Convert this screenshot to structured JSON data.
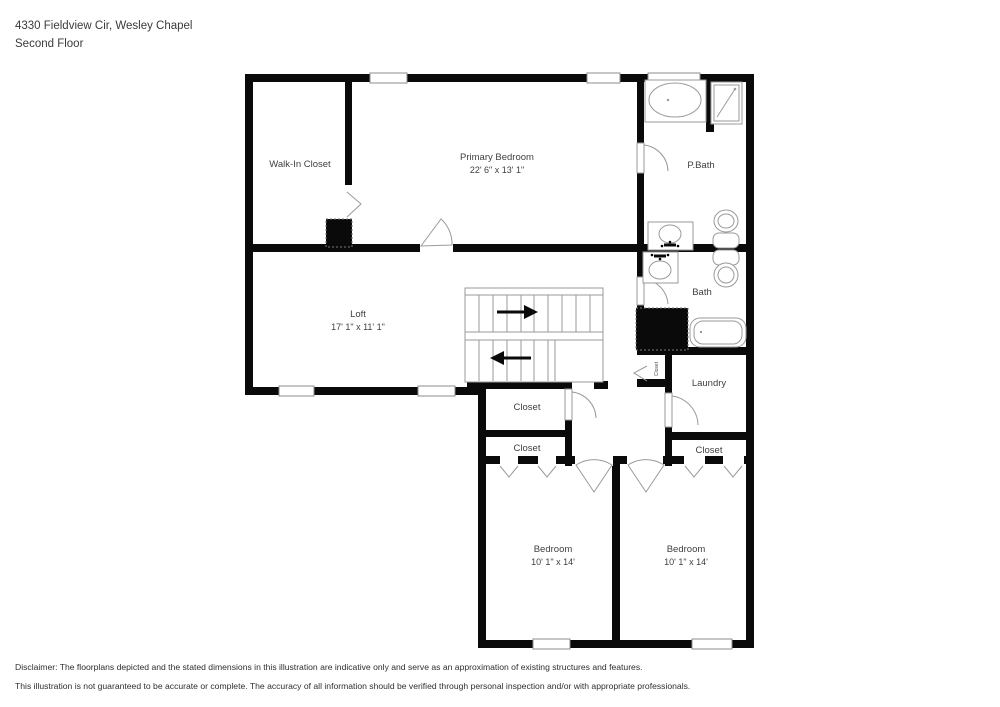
{
  "header": {
    "address_line": "4330 Fieldview Cir, Wesley Chapel",
    "floor_line": "Second Floor"
  },
  "rooms": {
    "walk_in_closet": {
      "label": "Walk-In Closet"
    },
    "primary_bedroom": {
      "label": "Primary Bedroom",
      "dims": "22' 6\" x 13' 1\""
    },
    "p_bath": {
      "label": "P.Bath"
    },
    "loft": {
      "label": "Loft",
      "dims": "17' 1\" x 11' 1\""
    },
    "bath": {
      "label": "Bath"
    },
    "laundry": {
      "label": "Laundry"
    },
    "closet_hall_upper": {
      "label": "Closet"
    },
    "closet_hall_lower": {
      "label": "Closet"
    },
    "closet_small_rotated": {
      "label": "Closet"
    },
    "closet_right": {
      "label": "Closet"
    },
    "bedroom_left": {
      "label": "Bedroom",
      "dims": "10' 1\" x 14'"
    },
    "bedroom_right": {
      "label": "Bedroom",
      "dims": "10' 1\" x 14'"
    }
  },
  "stairs": {
    "upper_flight_arrow": "right",
    "lower_flight_arrow": "left"
  },
  "fixtures": [
    "garden-tub",
    "shower",
    "sink",
    "toilet",
    "bathtub"
  ],
  "disclaimer": {
    "line1": "Disclaimer: The floorplans depicted and the stated dimensions in this illustration are indicative only and serve as an approximation of existing structures and features.",
    "line2": "This illustration is not guaranteed to be accurate or complete. The accuracy of all information should be verified through personal inspection and/or with appropriate professionals."
  },
  "colors": {
    "walls": "#0a0a0a",
    "fixture_outline": "#9a9a9a",
    "label_text": "#404040",
    "background": "#ffffff"
  }
}
